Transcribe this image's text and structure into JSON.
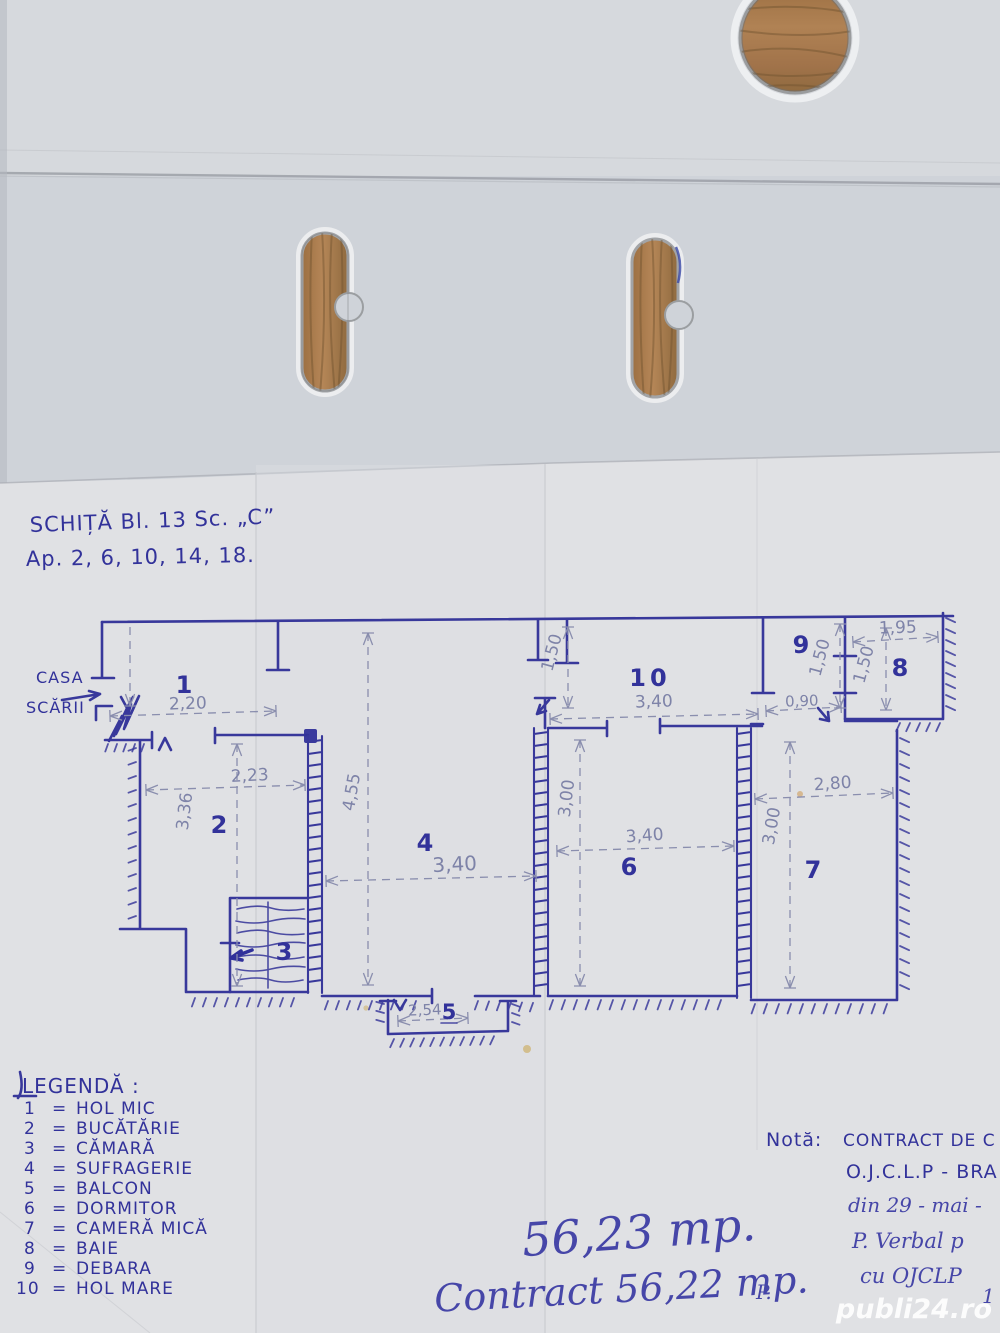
{
  "photo": {
    "watermark": "publi24.ro"
  },
  "sketch": {
    "title1": "SCHIȚĂ  Bl. 13  Sc. „C”",
    "title2": "Ap. 2, 6, 10, 14, 18.",
    "staircase1": "CASA",
    "staircase2": "SCĂRII",
    "rooms": [
      {
        "num": "1",
        "name": "HOL MIC"
      },
      {
        "num": "2",
        "name": "BUCĂTĂRIE"
      },
      {
        "num": "3",
        "name": "CĂMARĂ"
      },
      {
        "num": "4",
        "name": "SUFRAGERIE"
      },
      {
        "num": "5",
        "name": "BALCON"
      },
      {
        "num": "6",
        "name": "DORMITOR"
      },
      {
        "num": "7",
        "name": "CAMERĂ MICĂ"
      },
      {
        "num": "8",
        "name": "BAIE"
      },
      {
        "num": "9",
        "name": "DEBARA"
      },
      {
        "num": "10",
        "name": "HOL MARE"
      }
    ],
    "dims": {
      "room1_w": "2,20",
      "room2_w": "2,23",
      "room2_h": "3,36",
      "room4_w": "3,40",
      "room4_h": "4,55",
      "balcony_w": "2,54",
      "room6_w": "3,40",
      "room6_h": "3,00",
      "room7_w": "2,80",
      "room7_h": "3,00",
      "room10_w": "3,40",
      "room10_h": "1,50",
      "door9_w": "0,90",
      "room9_d": "1,50",
      "room8_w": "1,95",
      "room8_d": "1,50"
    },
    "legend": {
      "heading": "LEGENDĂ :",
      "eq": "="
    },
    "area1": "56,23 mp.",
    "area2": "Contract 56,22 mp.",
    "note": {
      "label": "Notă:",
      "line1": "CONTRACT DE C",
      "line2": "O.J.C.L.P - BRA",
      "line3": "din 29 - mai -",
      "line4": "P. Verbal p",
      "line5": "cu OJCLP",
      "frag1": "P.",
      "frag2": "1"
    }
  }
}
